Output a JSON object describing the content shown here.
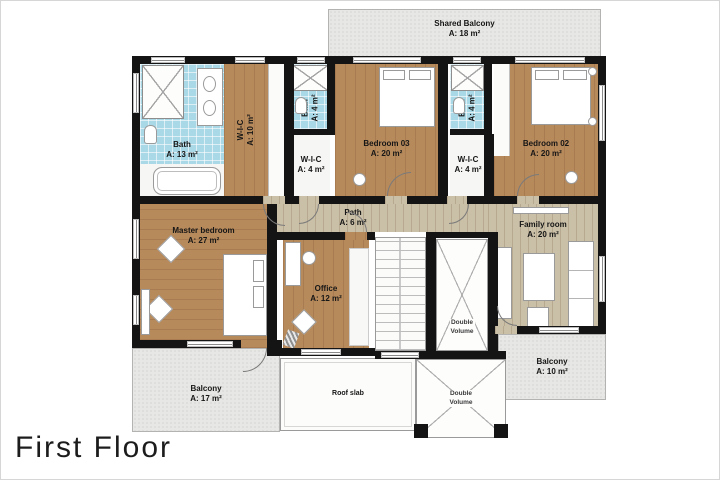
{
  "title": {
    "text": "First Floor"
  },
  "rooms": {
    "shared_balcony": {
      "name": "Shared Balcony",
      "area": "A: 18 m²"
    },
    "bath_13": {
      "name": "Bath",
      "area": "A: 13 m²"
    },
    "wic_10": {
      "name": "W-I-C",
      "area": "A: 10 m²"
    },
    "bath_4a": {
      "name": "Bath",
      "area": "A: 4 m²"
    },
    "wic_4a": {
      "name": "W-I-C",
      "area": "A: 4 m²"
    },
    "bedroom_03": {
      "name": "Bedroom 03",
      "area": "A: 20 m²"
    },
    "bath_4b": {
      "name": "Bath",
      "area": "A: 4 m²"
    },
    "wic_4b": {
      "name": "W-I-C",
      "area": "A: 4 m²"
    },
    "bedroom_02": {
      "name": "Bedroom 02",
      "area": "A: 20 m²"
    },
    "master_bedroom": {
      "name": "Master bedroom",
      "area": "A: 27 m²"
    },
    "path": {
      "name": "Path",
      "area": "A: 6 m²"
    },
    "family_room": {
      "name": "Family room",
      "area": "A: 20 m²"
    },
    "office": {
      "name": "Office",
      "area": "A: 12 m²"
    },
    "balcony_17": {
      "name": "Balcony",
      "area": "A: 17 m²"
    },
    "roof_slab": {
      "name": "Roof slab"
    },
    "double_volume_upper": {
      "line1": "Double",
      "line2": "Volume"
    },
    "double_volume_lower": {
      "line1": "Double",
      "line2": "Volume"
    },
    "balcony_10": {
      "name": "Balcony",
      "area": "A: 10 m²"
    }
  },
  "colors": {
    "wood": "#b78a5c",
    "light_wood": "#cabfa7",
    "tile": "#a9d8e6",
    "balcony_gray": "#e7e7e5",
    "wall": "#141414"
  }
}
